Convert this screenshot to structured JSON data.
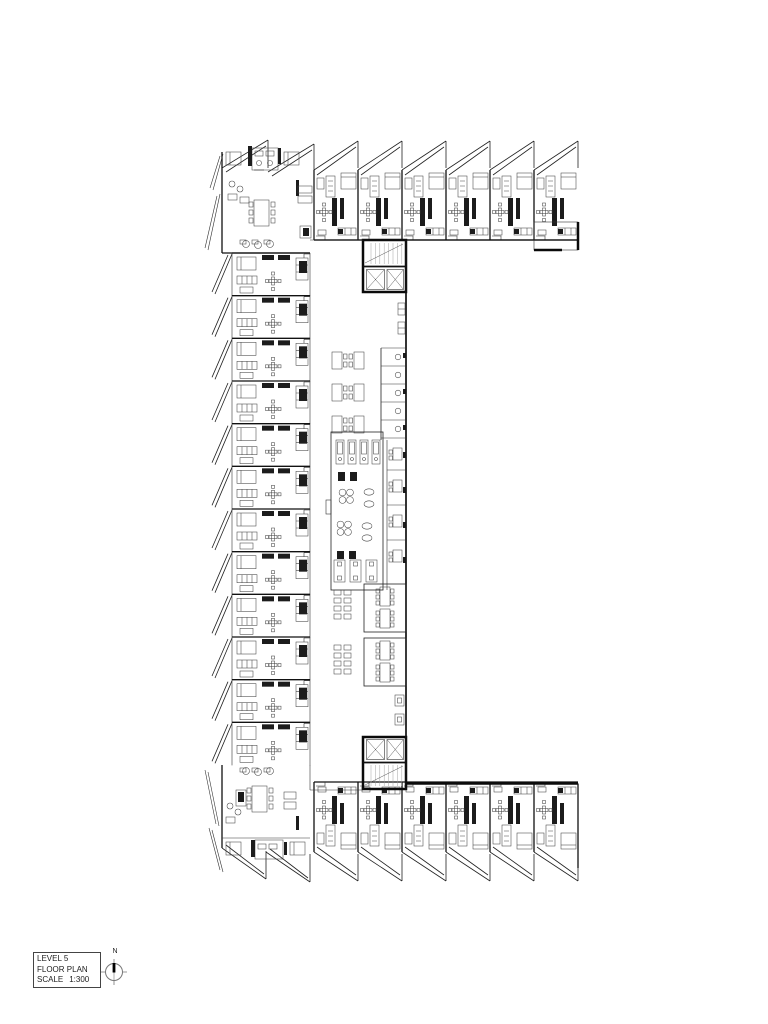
{
  "title_block": {
    "level": "LEVEL 5",
    "drawing_name": "FLOOR PLAN",
    "scale_label": "SCALE",
    "scale_value": "1:300"
  },
  "compass": {
    "north_label": "N"
  },
  "plan": {
    "type": "architectural-floor-plan",
    "building_shape": "C-shaped residential block around open courtyard",
    "line_color": "#1a1a1a",
    "top_wing": {
      "x0": 314,
      "y": 140,
      "unit_w": 44,
      "count": 6
    },
    "left_wing": {
      "x": 215,
      "y0": 253,
      "unit_h": 42.667,
      "count": 12
    },
    "bottom_wing": {
      "x0": 314,
      "flip_y": 882,
      "unit_w": 44,
      "count": 6
    },
    "corner_units": 2,
    "cores": 2
  }
}
